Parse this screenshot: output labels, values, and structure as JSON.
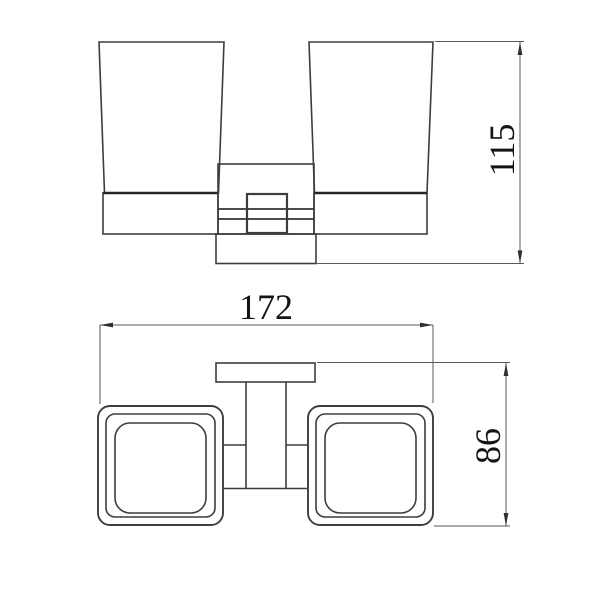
{
  "drawing": {
    "title": "double-tumbler-holder-technical-drawing",
    "background_color": "#ffffff",
    "object_line_color": "#3d3d3d",
    "dimension_line_color": "#5a5a5a",
    "text_color": "#141414",
    "front_view": {
      "dimensions": {
        "height": {
          "value": "115",
          "orientation": "vertical",
          "side": "right"
        }
      }
    },
    "plan_view": {
      "dimensions": {
        "width": {
          "value": "172",
          "orientation": "horizontal",
          "side": "top"
        },
        "depth": {
          "value": "86",
          "orientation": "vertical",
          "side": "right"
        }
      }
    }
  }
}
